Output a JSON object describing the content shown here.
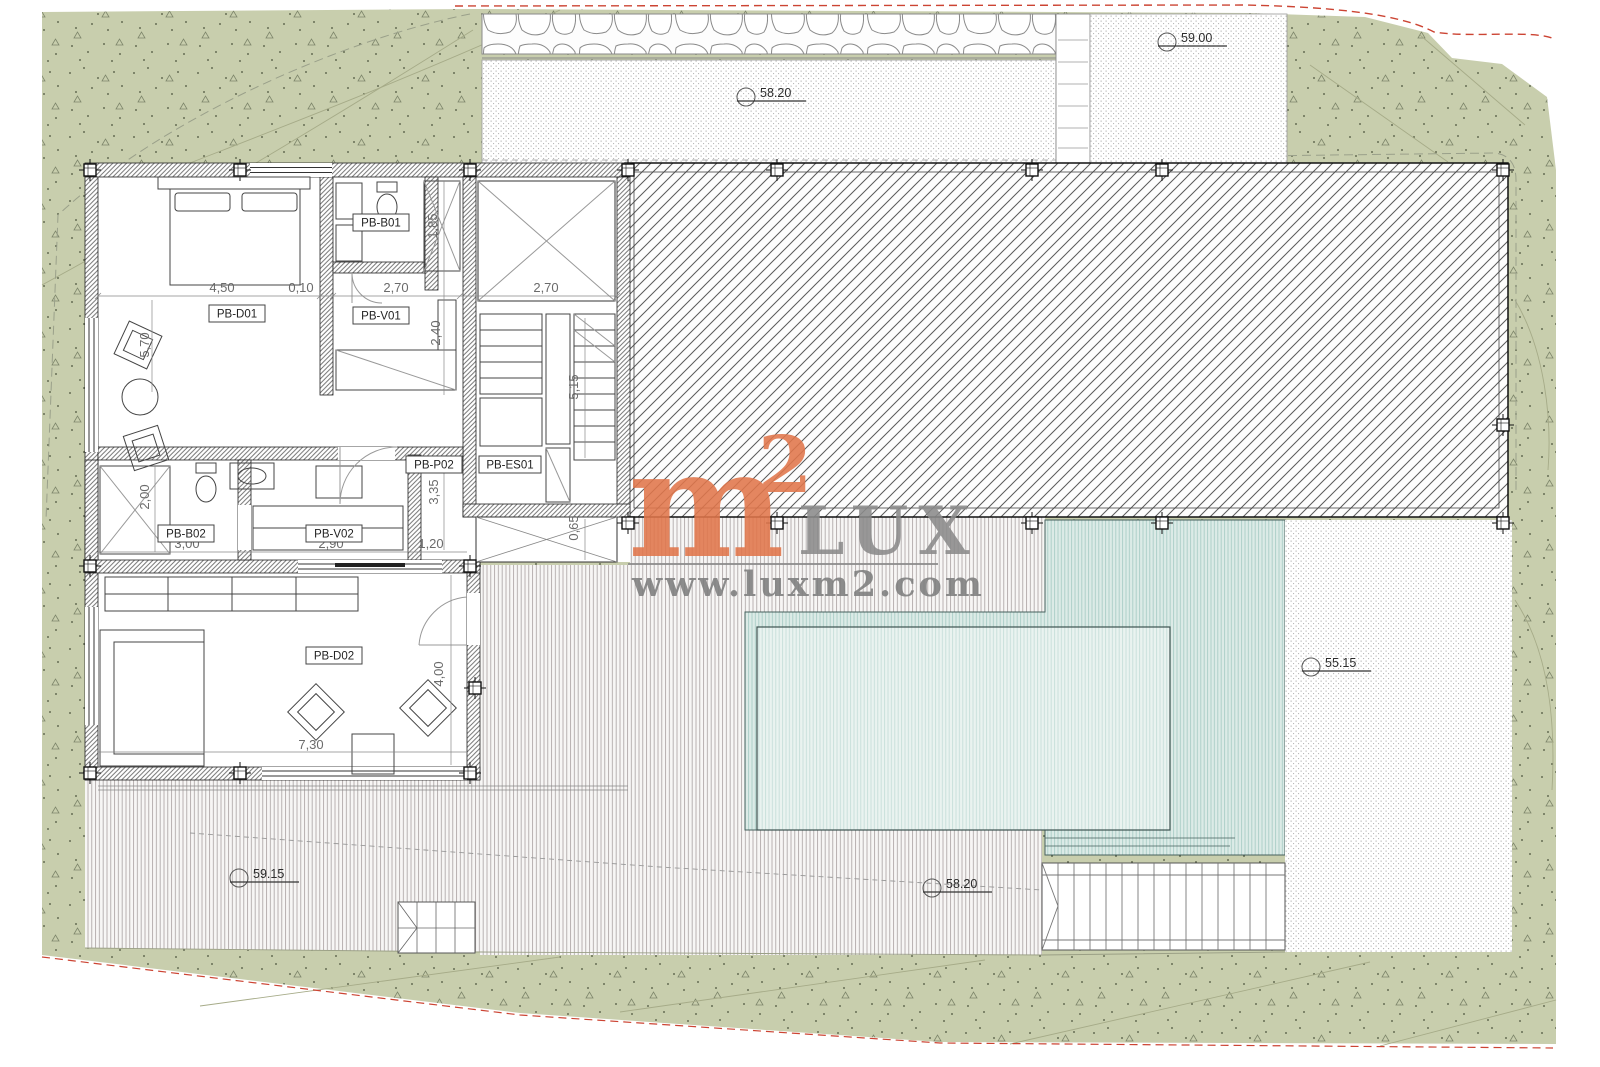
{
  "watermark": {
    "m": "m",
    "sup": "2",
    "lux": "LUX",
    "url": "www.luxm2.com",
    "orange": "#e1764b",
    "gray": "#8b8b8b"
  },
  "rooms": [
    {
      "label": "PB-D01"
    },
    {
      "label": "PB-B01"
    },
    {
      "label": "PB-V01"
    },
    {
      "label": "PB-P02"
    },
    {
      "label": "PB-ES01"
    },
    {
      "label": "PB-B02"
    },
    {
      "label": "PB-V02"
    },
    {
      "label": "PB-D02"
    }
  ],
  "dims": [
    {
      "text": "4,50"
    },
    {
      "text": "0,10"
    },
    {
      "text": "2,70"
    },
    {
      "text": "2,70"
    },
    {
      "text": "1,85"
    },
    {
      "text": "2,40"
    },
    {
      "text": "5,70"
    },
    {
      "text": "3,35"
    },
    {
      "text": "5,15"
    },
    {
      "text": "0,65"
    },
    {
      "text": "2,00"
    },
    {
      "text": "3,00"
    },
    {
      "text": "2,90"
    },
    {
      "text": "1,20"
    },
    {
      "text": "7,30"
    },
    {
      "text": "4,00"
    }
  ],
  "levels": [
    {
      "value": "58.20"
    },
    {
      "value": "59.00"
    },
    {
      "value": "55.15"
    },
    {
      "value": "59.15"
    },
    {
      "value": "58.20"
    }
  ],
  "colors": {
    "terrain_green": "#c8cead",
    "pool_teal": "#dcebe7",
    "pool_inner": "#eaf3f0",
    "boundary_red": "#cc4433",
    "watermark_orange": "#e1764b",
    "watermark_gray": "#8b8b8b"
  }
}
